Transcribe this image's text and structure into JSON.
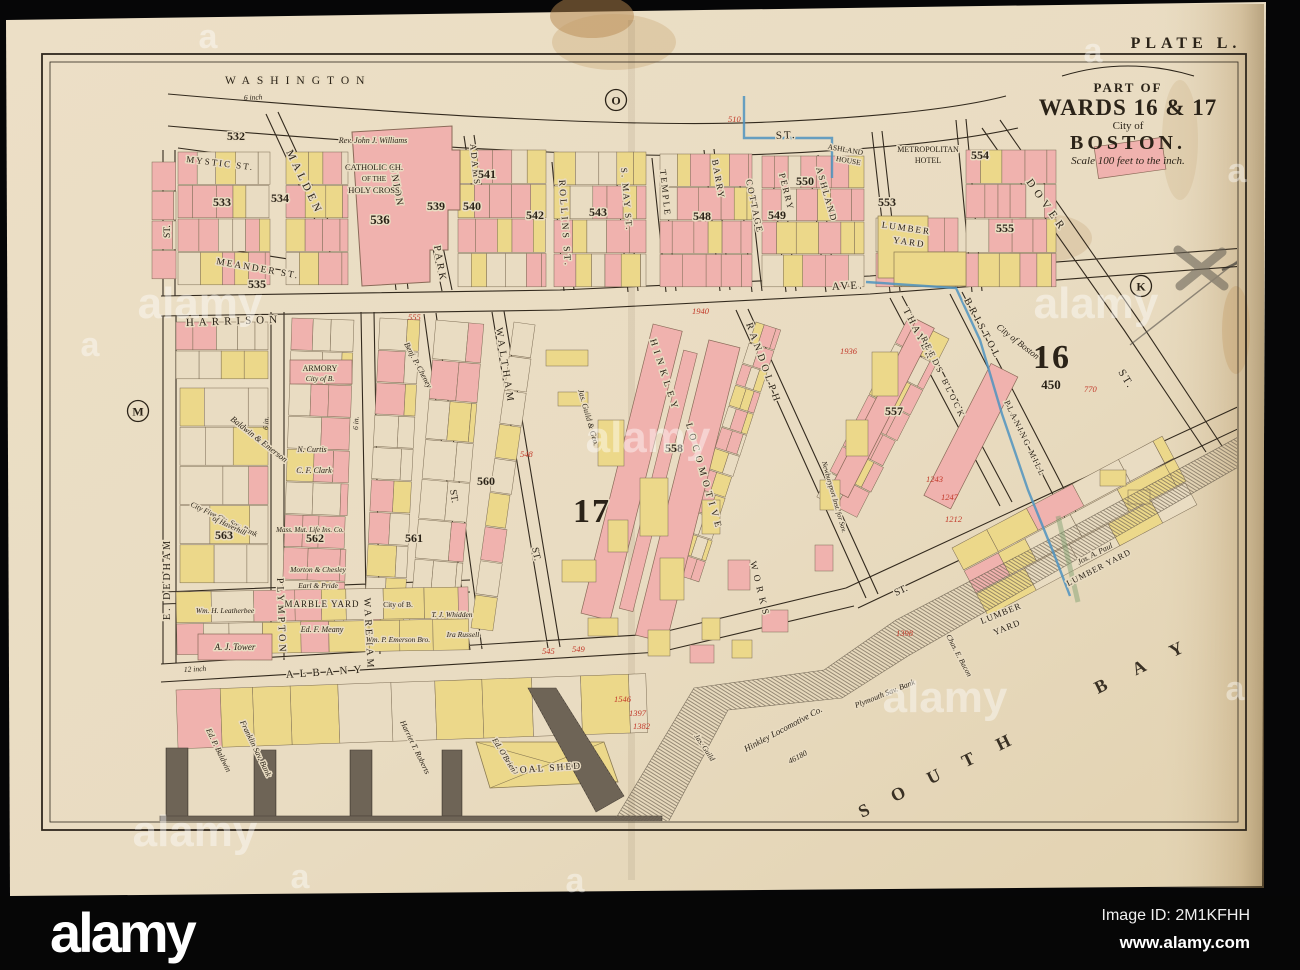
{
  "watermark": {
    "brand": "alamy",
    "image_id": "Image ID: 2M1KFHH",
    "website": "www.alamy.com",
    "tile_text": "alamy",
    "tile_letter": "a"
  },
  "map": {
    "plate_label": "PLATE L.",
    "cartouche": {
      "part_of": "PART OF",
      "wards": "WARDS 16 & 17",
      "city_of": "City of",
      "city": "BOSTON.",
      "scale": "Scale 100 feet to the inch."
    },
    "ward_numbers": {
      "sixteen": "16",
      "seventeen": "17"
    },
    "index_circles": [
      {
        "letter": "O"
      },
      {
        "letter": "K"
      },
      {
        "letter": "M"
      }
    ],
    "bay": {
      "word1": "SOUTH",
      "word2": "BAY"
    },
    "streets": [
      {
        "name": "WASHINGTON"
      },
      {
        "name": "ST."
      },
      {
        "name": "MYSTIC ST."
      },
      {
        "name": "ST."
      },
      {
        "name": "MALDEN"
      },
      {
        "name": "MEANDER ST."
      },
      {
        "name": "UNION"
      },
      {
        "name": "PARK"
      },
      {
        "name": "ADAMS"
      },
      {
        "name": "ROLLINS ST."
      },
      {
        "name": "S. MAY ST."
      },
      {
        "name": "TEMPLE"
      },
      {
        "name": "BARRY"
      },
      {
        "name": "COTTAGE"
      },
      {
        "name": "PERRY"
      },
      {
        "name": "ASHLAND"
      },
      {
        "name": "HARRISON"
      },
      {
        "name": "AVE."
      },
      {
        "name": "DOVER"
      },
      {
        "name": "ST."
      },
      {
        "name": "THAYER"
      },
      {
        "name": "BRISTOL"
      },
      {
        "name": "RANDOLPH"
      },
      {
        "name": "WALTHAM"
      },
      {
        "name": "ST."
      },
      {
        "name": "ST."
      },
      {
        "name": "WAREHAM"
      },
      {
        "name": "PLYMPTON"
      },
      {
        "name": "E. DEDHAM"
      },
      {
        "name": "ALBANY"
      },
      {
        "name": "ST."
      }
    ],
    "blocks": [
      "532",
      "533",
      "534",
      "535",
      "536",
      "539",
      "540",
      "541",
      "542",
      "543",
      "548",
      "549",
      "550",
      "553",
      "554",
      "555",
      "557",
      "558",
      "560",
      "561",
      "562",
      "563",
      "450"
    ],
    "places": [
      {
        "line1": "CATHOLIC CH.",
        "line2": "OF THE",
        "line3": "HOLY CROSS"
      },
      {
        "line1": "Rev. John J. Williams"
      },
      {
        "line1": "ARMORY",
        "line2": "City of B."
      },
      {
        "line1": "METROPOLITAN",
        "line2": "HOTEL"
      },
      {
        "line1": "ASHLAND",
        "line2": "HOUSE"
      },
      {
        "line1": "LUMBER",
        "line2": "YARD"
      },
      {
        "line1": "LUMBER",
        "line2": "YARD"
      },
      {
        "line1": "Jos. A. Paul",
        "line2": "LUMBER YARD"
      },
      {
        "line1": "MARBLE YARD"
      },
      {
        "line1": "COAL SHED"
      },
      {
        "line1": "PLANING MILL"
      },
      {
        "line1": "REEDS BLOCK"
      },
      {
        "line1": "HINKLEY"
      },
      {
        "line1": "LOCOMOTIVE"
      },
      {
        "line1": "WORKS"
      },
      {
        "line1": "Hinkley Locomotive Co.",
        "line2": "46180"
      },
      {
        "line1": "Plymouth Sav. Bank"
      },
      {
        "line1": "Chas. E. Bacon"
      },
      {
        "line1": "A. J. Tower"
      },
      {
        "line1": "Wm. H. Leatherbee"
      },
      {
        "line1": "Ed. F. Meany"
      },
      {
        "line1": "T. J. Whidden"
      },
      {
        "line1": "Wm. P. Emerson Bro."
      },
      {
        "line1": "Ira Russell"
      },
      {
        "line1": "City of B."
      },
      {
        "line1": "Ed. P. Baldwin"
      },
      {
        "line1": "Franklin Sav. Bank"
      },
      {
        "line1": "Harriet T. Roberts"
      },
      {
        "line1": "Ed. O'Brien"
      },
      {
        "line1": "Baldwin & Emerson"
      },
      {
        "line1": "N. Curtis"
      },
      {
        "line1": "C. F. Clark"
      },
      {
        "line1": "Mass. Mut. Life Ins. Co."
      },
      {
        "line1": "Benj. P. Cheney"
      },
      {
        "line1": "City Five Cts. Sav. Bank",
        "line2": "of Haverhill"
      },
      {
        "line1": "Newburyport Inst. for Sav."
      },
      {
        "line1": "Jas. Guild"
      },
      {
        "line1": "City of Boston"
      },
      {
        "line1": "Jas. Guild & Geo."
      },
      {
        "line1": "Morton & Chesley"
      },
      {
        "line1": "Earl & Pride"
      }
    ],
    "red_notes": [
      "510",
      "545",
      "549",
      "548",
      "555",
      "1940",
      "1936",
      "1243",
      "1247",
      "1212",
      "770",
      "1398",
      "1546",
      "1397",
      "1382"
    ],
    "pipe_notes": [
      "6 inch",
      "6 in.",
      "6 in.",
      "12 inch"
    ],
    "colors": {
      "paper": "#e9dcc2",
      "pink": "#f0b2ae",
      "yellow": "#ecd88a",
      "line": "#332a1e",
      "pipe_blue": "#4f93c0",
      "annotation_red": "#c2392a",
      "bar": "#060606"
    }
  }
}
